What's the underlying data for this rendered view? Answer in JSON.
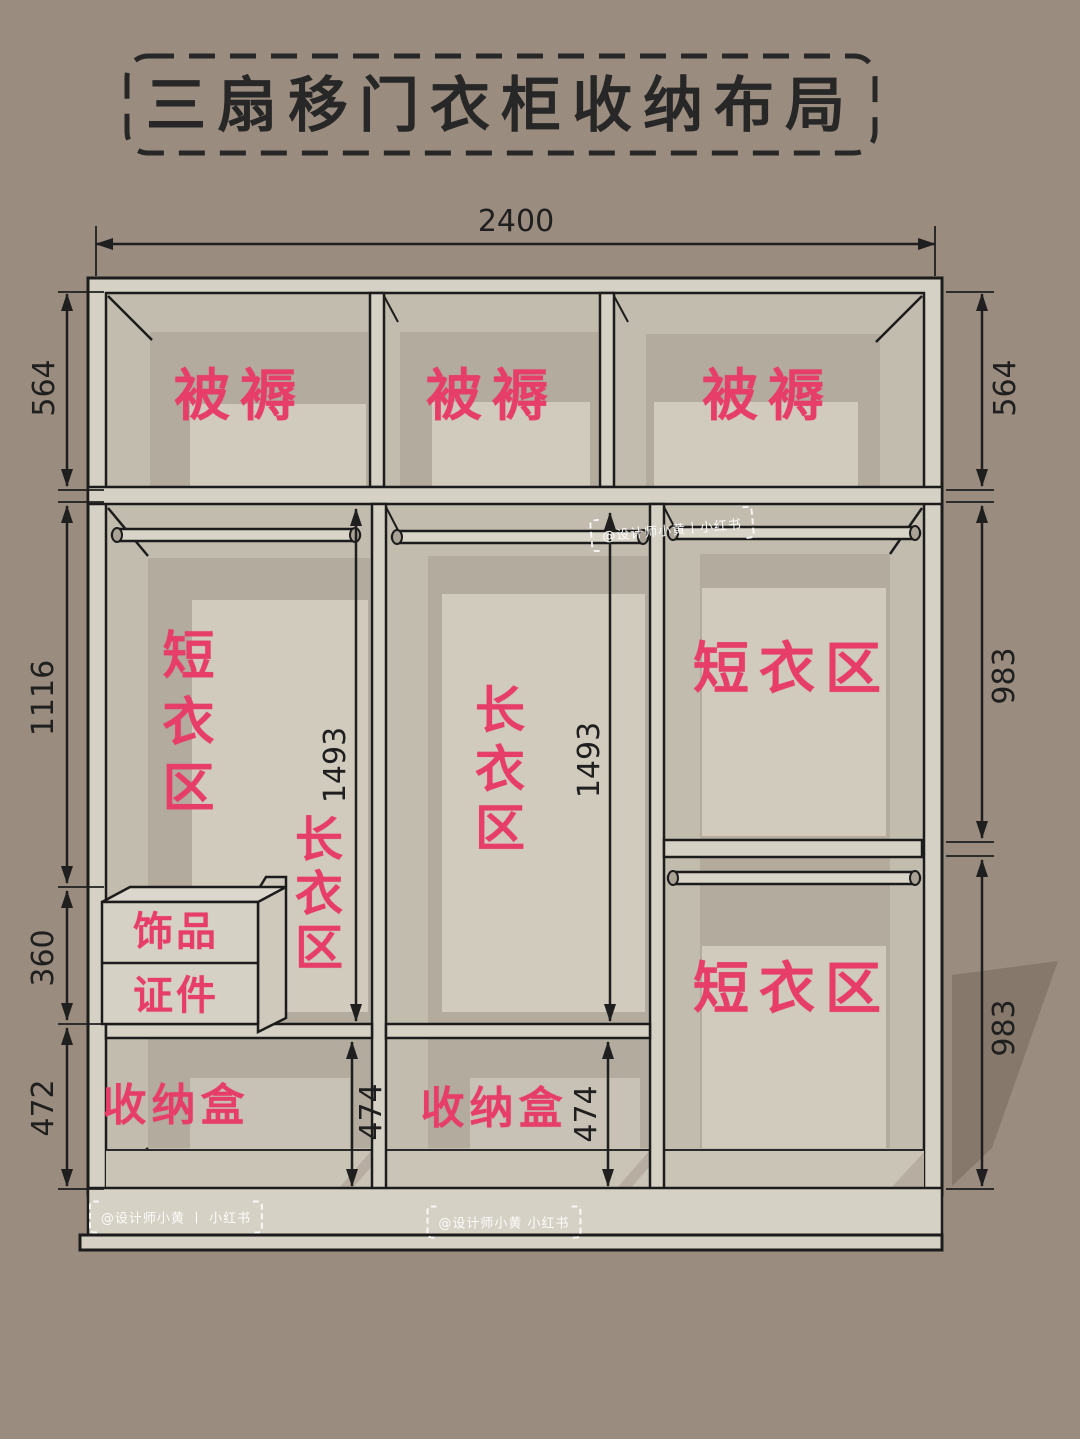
{
  "title": "三扇移门衣柜收纳布局",
  "colors": {
    "background": "#9a8c7e",
    "accent_pink": "#e63e68",
    "panel_light": "#d6d1c5",
    "panel_mid": "#c2bcaf",
    "back_panel_dark": "#b2ab9e",
    "back_panel_light": "#d1cbbe",
    "outline": "#1c1c1c",
    "shadow": "#86796b"
  },
  "dimensions": {
    "overall_width": "2400",
    "left_heights": [
      "564",
      "1116",
      "360",
      "472"
    ],
    "right_heights": [
      "564",
      "983",
      "983"
    ],
    "long_hanging_heights": [
      "1493",
      "1493"
    ],
    "storage_heights": [
      "474",
      "474"
    ]
  },
  "zones": {
    "top_shelf": [
      "被褥",
      "被褥",
      "被褥"
    ],
    "left_column": {
      "short_clothes": "短衣区",
      "long_clothes": "长衣区",
      "drawer_top": "饰品",
      "drawer_bottom": "证件",
      "storage": "收纳盒"
    },
    "middle_column": {
      "long_clothes": "长衣区",
      "storage": "收纳盒"
    },
    "right_column": {
      "short_clothes_upper": "短衣区",
      "short_clothes_lower": "短衣区"
    }
  },
  "watermarks": {
    "top_center": "@设计师小黄丨小红书",
    "bottom_left": "@设计师小黄 丨 小红书",
    "bottom_center": "@设计师小黄 小红书"
  }
}
